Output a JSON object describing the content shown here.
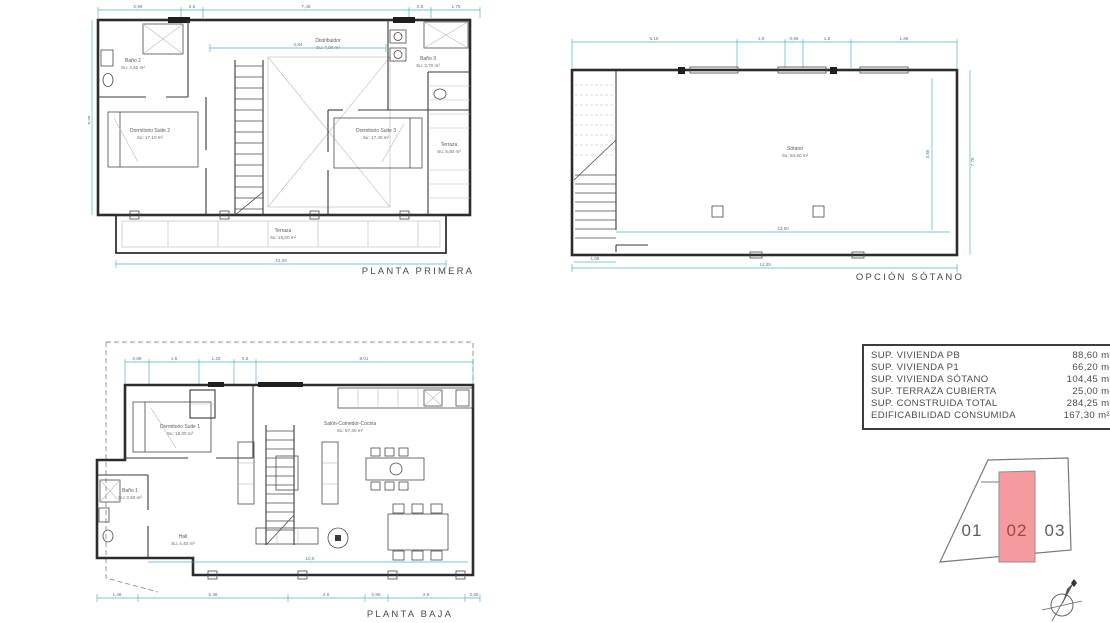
{
  "sheet": {
    "line_color": "#323232",
    "dim_color": "#53b2c6",
    "parcel_pink": "#f59ba0",
    "parcel_text_red": "#a04444"
  },
  "plans": {
    "primera": {
      "title": "PLANTA PRIMERA",
      "rooms": {
        "bano2": {
          "name": "Baño 2",
          "area": "Su: 4,40 m²"
        },
        "distribuidor": {
          "name": "Distribuidor",
          "area": "Su: 7,00 m²"
        },
        "bano3": {
          "name": "Baño 3",
          "area": "Su: 3,70 m²"
        },
        "suite2": {
          "name": "Dormitorio Suite 2",
          "area": "Su: 17,10 m²"
        },
        "suite3": {
          "name": "Dormitorio Suite 3",
          "area": "Su: 17,40 m²"
        },
        "terraza_lat": {
          "name": "Terraza",
          "area": "Su: 5,50 m²"
        },
        "terraza": {
          "name": "Terraza",
          "area": "Su: 15,00 m²"
        }
      },
      "dims": {
        "top": [
          "2,99",
          "0,8",
          "7,45",
          "0,8",
          "1,75"
        ],
        "inner_w": "4,84",
        "bottom": "12,06",
        "left": "6,56"
      }
    },
    "sotano": {
      "title": "OPCIÓN SÓTANO",
      "rooms": {
        "sotano": {
          "name": "Sótano",
          "area": "Su: 84,50 m²"
        }
      },
      "dims": {
        "top": [
          "6,16",
          "1,8",
          "0,66",
          "1,8",
          "1,85"
        ],
        "right": "7,75",
        "inner_v": "4,65",
        "inner_b": "13,60",
        "bottom": "14,35",
        "stair": "1,06"
      }
    },
    "baja": {
      "title": "PLANTA BAJA",
      "rooms": {
        "suite1": {
          "name": "Dormitorio Suite 1",
          "area": "Su: 15,30 m²"
        },
        "bano1": {
          "name": "Baño 1",
          "area": "Su: 3,50 m²"
        },
        "hall": {
          "name": "Hall",
          "area": "Su: 4,40 m²"
        },
        "salon": {
          "name": "Salón-Comedor-Cocina",
          "area": "Su: 57,40 m²"
        }
      },
      "dims": {
        "top": [
          "0,88",
          "1,8",
          "1,25",
          "0,8",
          "8,01"
        ],
        "bottom": [
          "1,48",
          "5,48",
          "2,8",
          "0,85",
          "2,8",
          "0,55"
        ],
        "inner": "10,6"
      }
    }
  },
  "area_table": {
    "rows": [
      {
        "label": "SUP. VIVIENDA PB",
        "value": "88,60 m²"
      },
      {
        "label": "SUP. VIVIENDA P1",
        "value": "66,20 m²"
      },
      {
        "label": "SUP. VIVIENDA SÓTANO",
        "value": "104,45 m²"
      },
      {
        "label": "SUP. TERRAZA CUBIERTA",
        "value": "25,00 m²"
      },
      {
        "label": "SUP. CONSTRUIDA TOTAL",
        "value": "284,25 m²"
      },
      {
        "label": "EDIFICABILIDAD CONSUMIDA",
        "value": "167,30 m²t"
      }
    ]
  },
  "plot_diagram": {
    "highlighted": "02",
    "parcels": [
      {
        "id": "01"
      },
      {
        "id": "02"
      },
      {
        "id": "03"
      }
    ]
  }
}
